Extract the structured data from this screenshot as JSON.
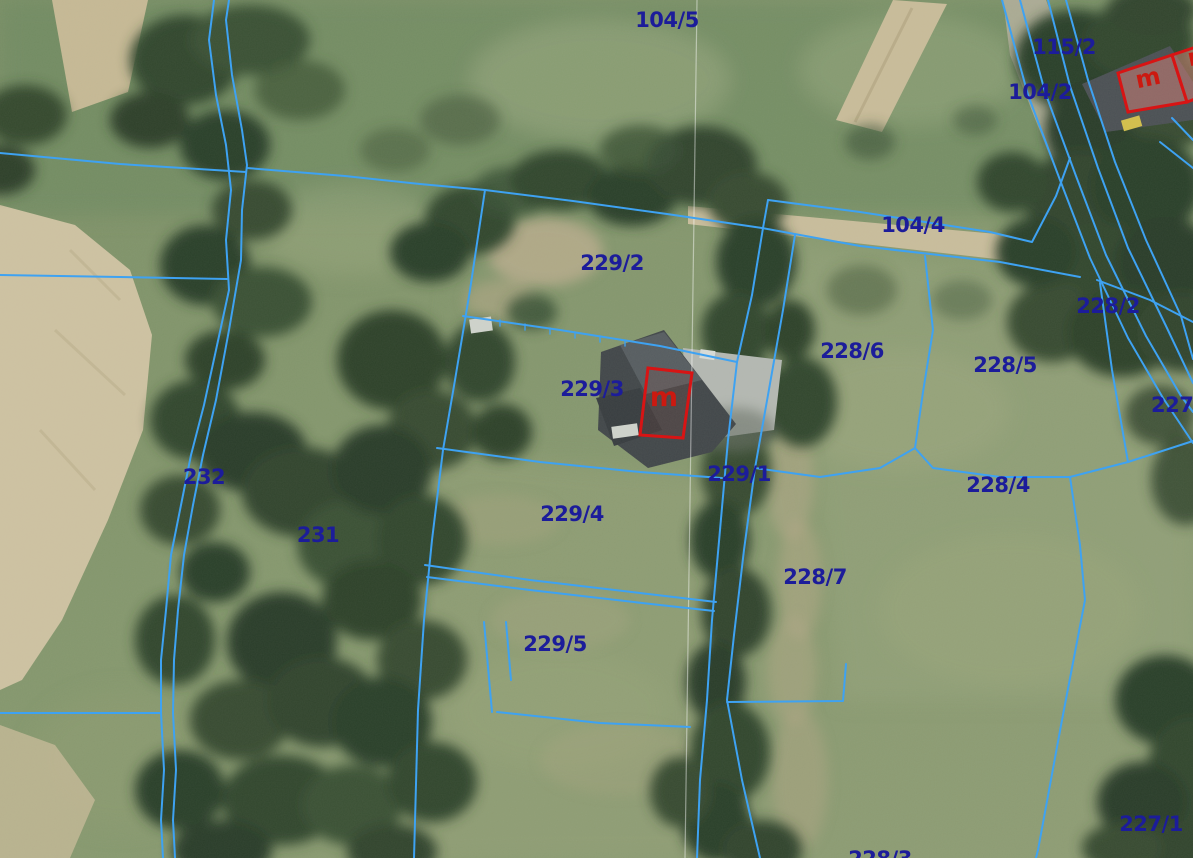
{
  "map": {
    "kind": "cadastral-parcel-overlay-on-aerial-photo",
    "colors": {
      "boundary_line": "#3ea2f2",
      "parcel_label": "#1c1c9a",
      "building_outline": "#d81414",
      "building_letter": "#cc1910",
      "sheet_line": "#ffffff"
    },
    "parcel_labels": [
      {
        "id": "104-5",
        "text": "104/5"
      },
      {
        "id": "115-2",
        "text": "115/2"
      },
      {
        "id": "104-2",
        "text": "104/2"
      },
      {
        "id": "104-4",
        "text": "104/4"
      },
      {
        "id": "229-2",
        "text": "229/2"
      },
      {
        "id": "228-2",
        "text": "228/2"
      },
      {
        "id": "228-6",
        "text": "228/6"
      },
      {
        "id": "228-5",
        "text": "228/5"
      },
      {
        "id": "227-right-edge",
        "text": "227/1"
      },
      {
        "id": "229-3",
        "text": "229/3"
      },
      {
        "id": "229-1",
        "text": "229/1"
      },
      {
        "id": "228-4",
        "text": "228/4"
      },
      {
        "id": "232",
        "text": "232"
      },
      {
        "id": "231",
        "text": "231"
      },
      {
        "id": "229-4",
        "text": "229/4"
      },
      {
        "id": "228-7",
        "text": "228/7"
      },
      {
        "id": "229-5",
        "text": "229/5"
      },
      {
        "id": "227-1",
        "text": "227/1"
      },
      {
        "id": "228-3",
        "text": "228/3"
      }
    ],
    "building_letters": [
      {
        "id": "house-center",
        "text": "m"
      },
      {
        "id": "house-northeast",
        "text": "m"
      },
      {
        "id": "house-northeast-partial",
        "text": "m"
      }
    ]
  }
}
